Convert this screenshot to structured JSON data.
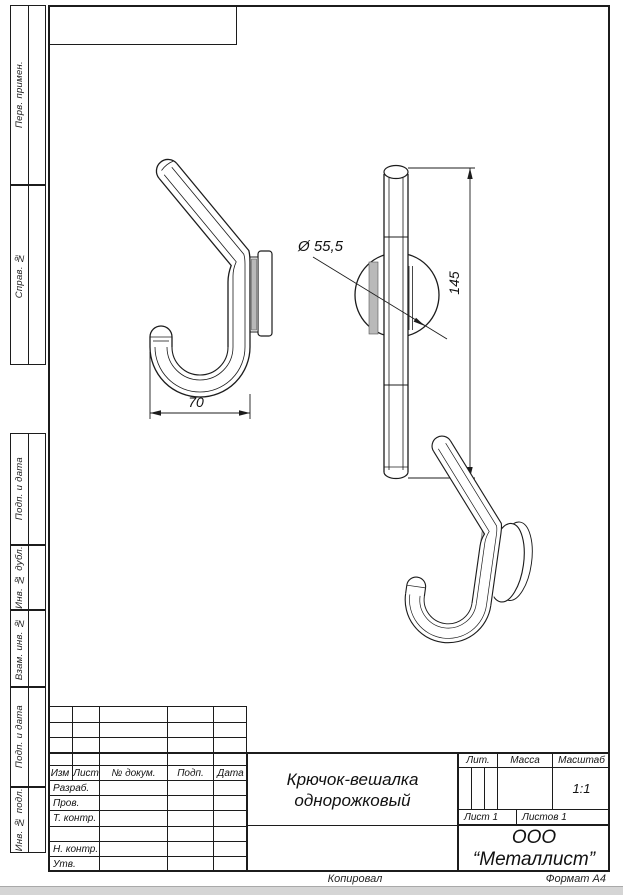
{
  "sheet": {
    "margin_labels": [
      "Перв. примен.",
      "Справ. №",
      "Подп. и дата",
      "Инв. № дубл.",
      "Взам. инв. №",
      "Подп. и дата",
      "Инв. № подл."
    ],
    "footer": {
      "copied": "Копировал",
      "format": "Формат А4"
    }
  },
  "drawing": {
    "part_name": "Крючок-вешалка однорожковый",
    "dimensions": {
      "width": "70",
      "height": "145",
      "diameter": "Ø 55,5"
    }
  },
  "title_block": {
    "header_columns": [
      "Изм",
      "Лист",
      "№ докум.",
      "Подп.",
      "Дата"
    ],
    "row_labels": [
      "Разраб.",
      "Пров.",
      "Т. контр.",
      "",
      "Н. контр.",
      "Утв."
    ],
    "name_line1": "Крючок-вешалка",
    "name_line2": "однорожковый",
    "lit": "Лит.",
    "mass": "Масса",
    "scale": "Масштаб",
    "scale_value": "1:1",
    "sheet": "Лист 1",
    "sheets": "Листов 1",
    "company_line1": "ООО",
    "company_line2": "“Металлист”"
  }
}
